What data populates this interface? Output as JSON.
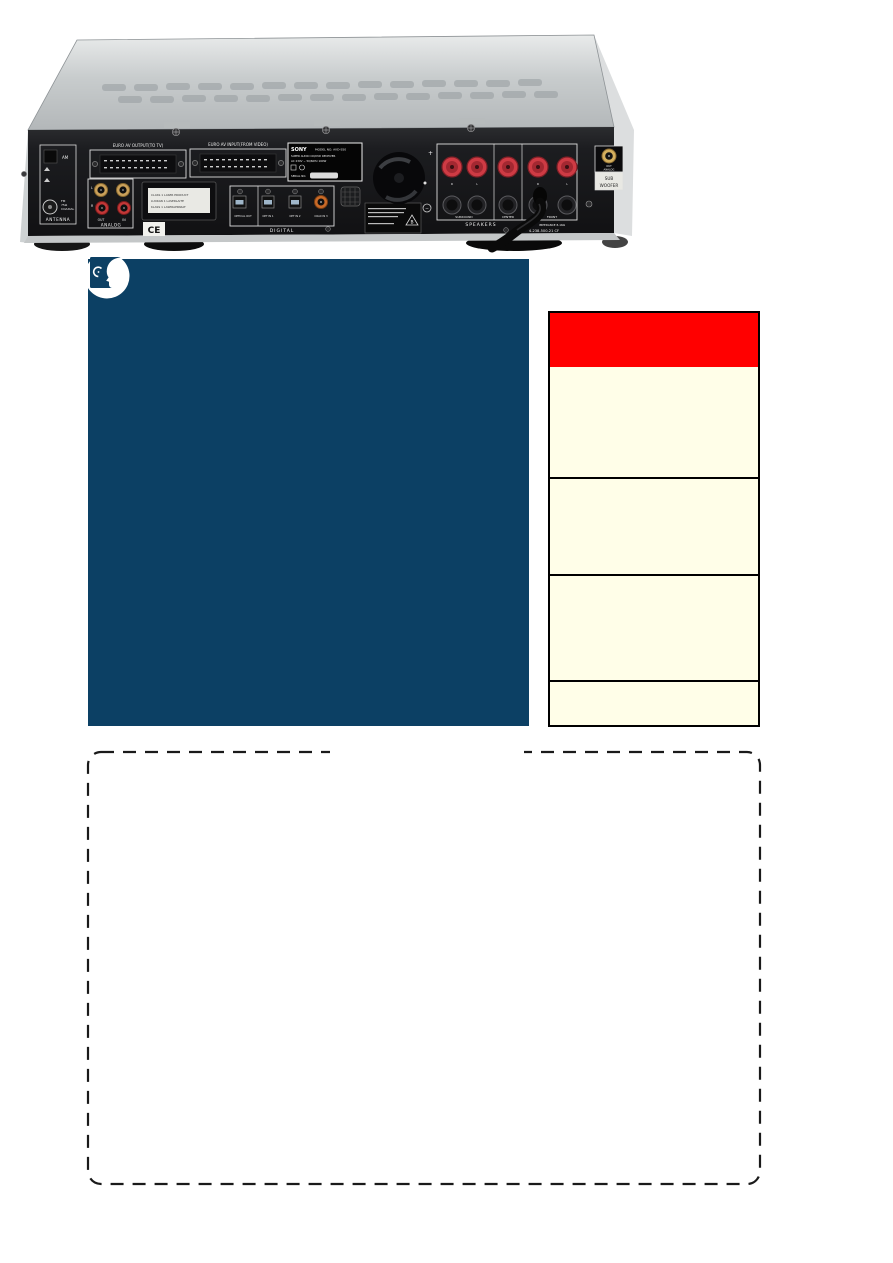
{
  "page": {
    "background": "#ffffff",
    "type": "scanned manual page"
  },
  "photo": {
    "labels": {
      "euro_out": "EURO AV OUTPUT(TO TV)",
      "euro_in": "EURO AV INPUT(FROM VIDEO)",
      "antenna": "ANTENNA",
      "am": "AM",
      "fm": "FM",
      "fm_ohm": "75Ω",
      "fm_coax": "COAXIAL",
      "l": "L",
      "r": "R",
      "out": "OUT",
      "in": "IN",
      "analog": "ANALOG",
      "laser1": "CLASS 1 LASER PRODUCT",
      "laser2": "LUOKAN 1 LASERLAITE",
      "laser3": "KLASS 1 LASERAPPARAT",
      "ce": "CE",
      "optical_out": "OPTICAL OUT",
      "opt_in_1": "OPT IN 1",
      "opt_in_2": "OPT IN 2",
      "coax_in_3": "COAX IN 3",
      "digital": "DIGITAL",
      "brand": "SONY",
      "model": "MODEL NO. AVD-S50",
      "product": "SUPER AUDIO CD/DVD RECEIVER",
      "power": "AC 230V ~ 50/60Hz 160W",
      "serial": "SERIAL NO.",
      "caution_mark": "B",
      "surround": "SURROUND",
      "center": "CENTER",
      "front": "FRONT",
      "speakers": "SPEAKERS",
      "impedance": "IMPEDANCE 8-16Ω",
      "plus": "+",
      "minus": "−",
      "sub_out": "OUT",
      "sub_analog": "ANALOG",
      "sub1": "SUB",
      "sub2": "WOOFER",
      "part_number": "4-238-500-21 CF"
    }
  },
  "info_panel": {
    "background": "#0c4064",
    "icon": "head-profile-listening"
  },
  "sidebar_table": {
    "border_color": "#000000",
    "background": "#fffee8",
    "header_color": "#ff0000",
    "rows": 4
  },
  "note_box": {
    "border_style": "dashed",
    "border_color": "#1a1a1a",
    "top_border_gap": true
  }
}
